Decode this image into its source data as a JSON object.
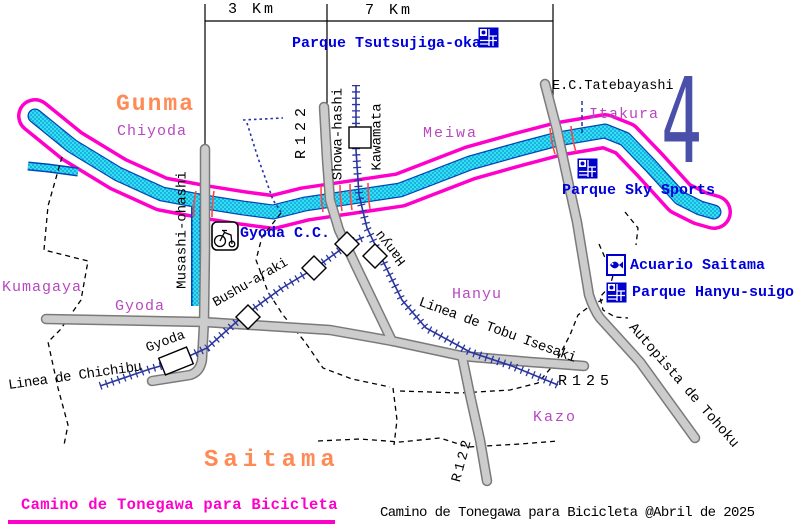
{
  "map": {
    "scale_bar": {
      "segment_left": "3 Km",
      "segment_right": "7 Km"
    },
    "regions": {
      "gunma": "Gunma",
      "saitama": "Saitama"
    },
    "areas": {
      "chiyoda": "Chiyoda",
      "meiwa": "Meiwa",
      "itakura": "Itakura",
      "kumagaya": "Kumagaya",
      "gyoda": "Gyoda",
      "hanyu": "Hanyu",
      "kazo": "Kazo"
    },
    "pois": {
      "parque_tsutsujigaoka": "Parque Tsutsujiga-oka",
      "tatebayashi": "E.C.Tatebayashi",
      "parque_sky_sports": "Parque Sky Sports",
      "gyoda_cc": "Gyoda C.C.",
      "acuario_saitama": "Acuario Saitama",
      "parque_hanyu_suigo": "Parque Hanyu-suigo"
    },
    "roads": {
      "r122_north": "R122",
      "r122_south": "R122",
      "r125": "R125",
      "autopista": "Autopista de Tohoku"
    },
    "railways": {
      "tobu_isesaki": "Linea de Tobu Isesaki",
      "chichibu": "Linea de Chichibu"
    },
    "bridges": {
      "musashi_ohashi": "Musashi-ohashi",
      "showa_hashi": "Showa-hashi"
    },
    "stations": {
      "kawamata": "Kawamata",
      "bushu_araki": "Bushu-araki",
      "hanyu": "Hanyu",
      "gyoda": "Gyoda"
    },
    "landmark_number": "4",
    "footer": {
      "title": "Camino de Tonegawa para Bicicleta",
      "credit": "Camino de Tonegawa para Bicicleta @Abril de 2025"
    },
    "icons": [
      "park-icon",
      "aquarium-icon",
      "bicycle-icon"
    ],
    "colors": {
      "river_fill": "#2ee2f4",
      "river_edge": "#0046b4",
      "river_border": "#ff00cc",
      "road_fill": "#cccccc",
      "road_edge": "#7a7a7a",
      "railway": "#2a35a0",
      "bridge_mark": "#ff4646",
      "poi_text": "#0000dd",
      "area_text": "#b848c0",
      "region_text": "#ff8a55",
      "title_text": "#ff00cc",
      "number_glyph": "#4a50aa",
      "boundary": "#000000"
    }
  }
}
